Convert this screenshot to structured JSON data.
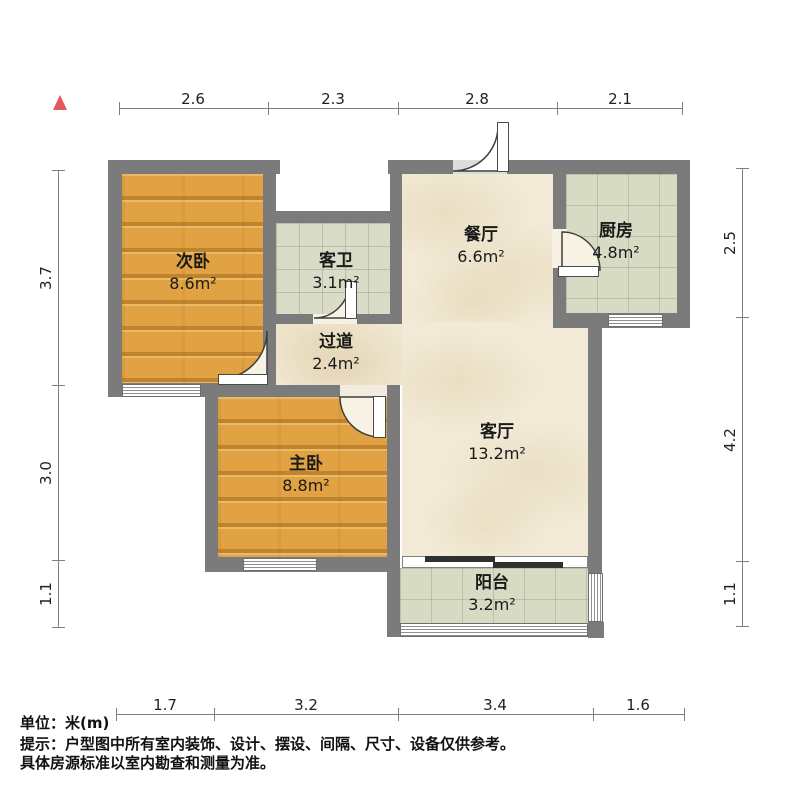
{
  "plan_title": "户型图",
  "unit": "米(m)",
  "rooms": {
    "secondary_bedroom": {
      "label": "次卧",
      "area": "8.6m²"
    },
    "guest_bathroom": {
      "label": "客卫",
      "area": "3.1m²"
    },
    "dining_room": {
      "label": "餐厅",
      "area": "6.6m²"
    },
    "kitchen": {
      "label": "厨房",
      "area": "4.8m²"
    },
    "hallway": {
      "label": "过道",
      "area": "2.4m²"
    },
    "living_room": {
      "label": "客厅",
      "area": "13.2m²"
    },
    "master_bedroom": {
      "label": "主卧",
      "area": "8.8m²"
    },
    "balcony": {
      "label": "阳台",
      "area": "3.2m²"
    }
  },
  "dimensions": {
    "top": [
      "2.6",
      "2.3",
      "2.8",
      "2.1"
    ],
    "bottom": [
      "1.7",
      "3.2",
      "3.4",
      "1.6"
    ],
    "left": [
      "3.7",
      "3.0",
      "1.1"
    ],
    "right": [
      "2.5",
      "4.2",
      "1.1"
    ]
  },
  "footer": {
    "unit_line": "单位：米(m)",
    "tip_line1": "提示：户型图中所有室内装饰、设计、摆设、间隔、尺寸、设备仅供参考。",
    "tip_line2": "具体房源标准以室内勘查和测量为准。"
  },
  "colors": {
    "wall": "#7b7b7b",
    "wood_floor": "#e0a242",
    "tile_floor": "#d9dcc6",
    "marble_floor": "#f2ead6",
    "north_arrow": "#e8575c",
    "sliding_door": "#2f2f2f"
  }
}
